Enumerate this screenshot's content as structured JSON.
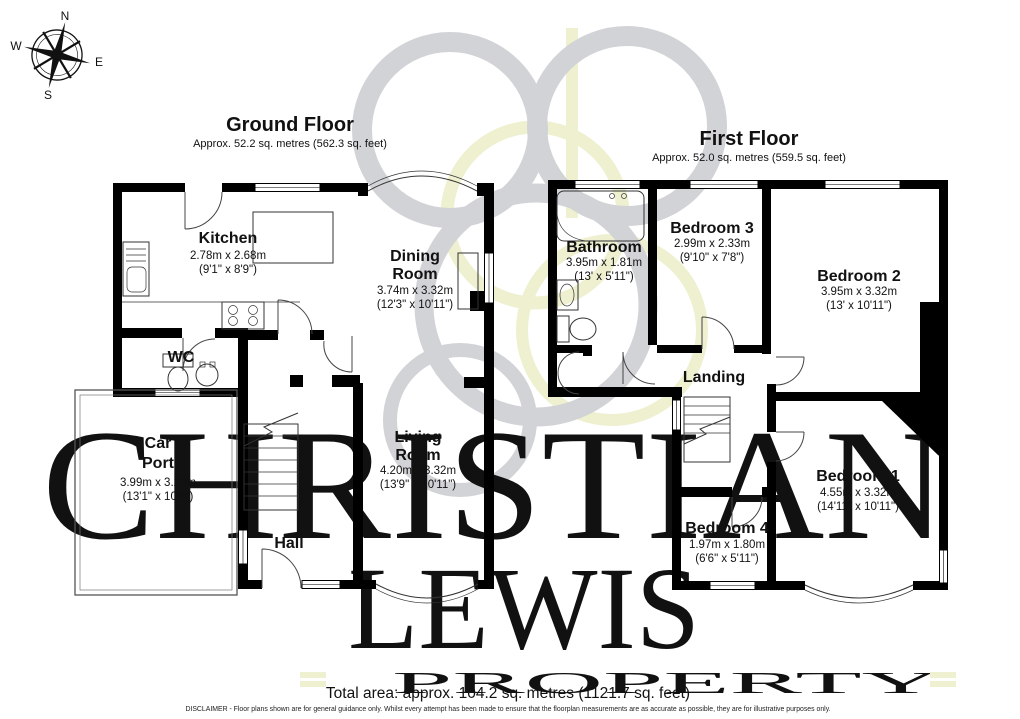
{
  "compass": {
    "n": "N",
    "s": "S",
    "e": "E",
    "w": "W"
  },
  "ground_floor": {
    "title": "Ground Floor",
    "area": "Approx. 52.2 sq. metres (562.3 sq. feet)",
    "rooms": {
      "kitchen": {
        "name": "Kitchen",
        "metric": "2.78m x 2.68m",
        "imperial": "(9'1\" x 8'9\")"
      },
      "dining": {
        "name1": "Dining",
        "name2": "Room",
        "metric": "3.74m x 3.32m",
        "imperial": "(12'3\" x 10'11\")"
      },
      "wc": {
        "name": "WC"
      },
      "carport": {
        "name1": "Car",
        "name2": "Port",
        "metric": "3.99m x 3.20m",
        "imperial": "(13'1\" x 10'6\")"
      },
      "hall": {
        "name": "Hall"
      },
      "living": {
        "name1": "Living",
        "name2": "Room",
        "metric": "4.20m x 3.32m",
        "imperial": "(13'9\" x 10'11\")"
      }
    }
  },
  "first_floor": {
    "title": "First Floor",
    "area": "Approx. 52.0 sq. metres (559.5 sq. feet)",
    "rooms": {
      "bathroom": {
        "name": "Bathroom",
        "metric": "3.95m x 1.81m",
        "imperial": "(13' x 5'11\")"
      },
      "bedroom3": {
        "name": "Bedroom 3",
        "metric": "2.99m x 2.33m",
        "imperial": "(9'10\" x 7'8\")"
      },
      "bedroom2": {
        "name": "Bedroom 2",
        "metric": "3.95m x 3.32m",
        "imperial": "(13' x 10'11\")"
      },
      "landing": {
        "name": "Landing"
      },
      "bedroom4": {
        "name": "Bedroom 4",
        "metric": "1.97m x 1.80m",
        "imperial": "(6'6\" x 5'11\")"
      },
      "bedroom1": {
        "name": "Bedroom 1",
        "metric": "4.55m x 3.32m",
        "imperial": "(14'11\" x 10'11\")"
      }
    }
  },
  "watermark": {
    "line1": "CHRISTIAN",
    "line2": "LEWIS",
    "line3": "PROPERTY"
  },
  "footer": {
    "total_area": "Total area: approx. 104.2 sq. metres (1121.7 sq. feet)",
    "disclaimer": "DISCLAIMER -  Floor plans shown are for general guidance only. Whilst every attempt has been made to ensure that the floorplan measurements are as accurate as possible, they are for illustrative purposes only."
  },
  "colors": {
    "wall": "#000000",
    "watermark_gray": "#d2d3d7",
    "watermark_yellow": "#eef0cf",
    "watermark_text_gray": "#c8cacf",
    "watermark_text_yellow": "#f1f2d7"
  }
}
